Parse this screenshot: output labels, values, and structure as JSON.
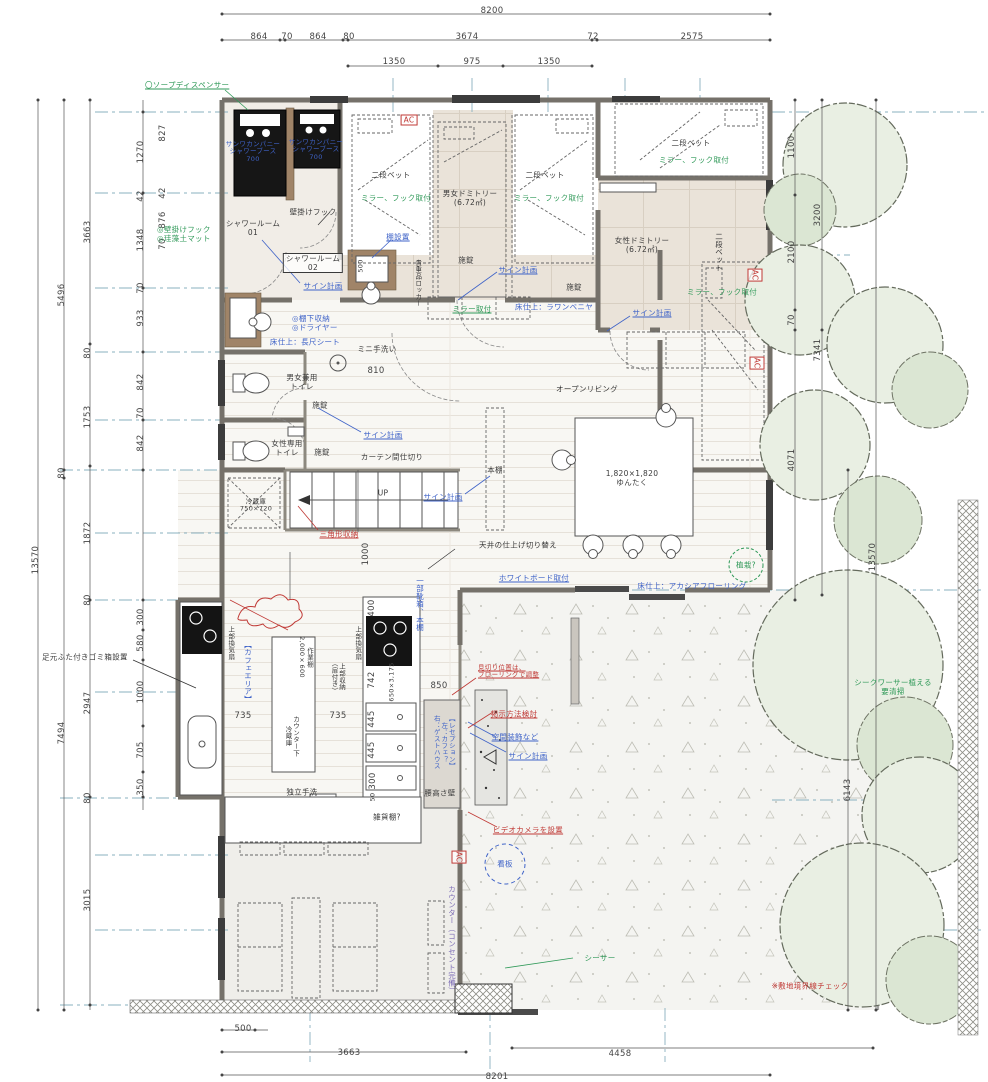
{
  "meta": {
    "drawing_type": "guesthouse-cafe floor plan",
    "unit": "mm"
  },
  "colors": {
    "annotation_green": "#2f9958",
    "annotation_blue": "#3f63c8",
    "annotation_red": "#c03a36",
    "wall": "#75716a",
    "floor_beige": "#eae3d9",
    "tree_green": "#e9efe3"
  },
  "labels": [
    {
      "t": "8200",
      "x": 492,
      "y": 11,
      "c": "dm",
      "n": "dim-top-total"
    },
    {
      "t": "864",
      "x": 259,
      "y": 37,
      "c": "dm"
    },
    {
      "t": "70",
      "x": 287,
      "y": 37,
      "c": "dm"
    },
    {
      "t": "864",
      "x": 318,
      "y": 37,
      "c": "dm"
    },
    {
      "t": "80",
      "x": 349,
      "y": 37,
      "c": "dm"
    },
    {
      "t": "3674",
      "x": 467,
      "y": 37,
      "c": "dm"
    },
    {
      "t": "72",
      "x": 593,
      "y": 37,
      "c": "dm"
    },
    {
      "t": "2575",
      "x": 692,
      "y": 37,
      "c": "dm"
    },
    {
      "t": "1350",
      "x": 394,
      "y": 62,
      "c": "dm"
    },
    {
      "t": "975",
      "x": 472,
      "y": 62,
      "c": "dm"
    },
    {
      "t": "1350",
      "x": 549,
      "y": 62,
      "c": "dm"
    },
    {
      "t": "13570",
      "x": 36,
      "y": 560,
      "c": "dm rv",
      "n": "dim-left-total"
    },
    {
      "t": "5496",
      "x": 62,
      "y": 295,
      "c": "dm rv"
    },
    {
      "t": "80",
      "x": 62,
      "y": 473,
      "c": "dm rv"
    },
    {
      "t": "7494",
      "x": 62,
      "y": 733,
      "c": "dm rv"
    },
    {
      "t": "3663",
      "x": 88,
      "y": 232,
      "c": "dm rv"
    },
    {
      "t": "80",
      "x": 88,
      "y": 353,
      "c": "dm rv"
    },
    {
      "t": "1753",
      "x": 88,
      "y": 417,
      "c": "dm rv"
    },
    {
      "t": "1872",
      "x": 88,
      "y": 533,
      "c": "dm rv"
    },
    {
      "t": "80",
      "x": 88,
      "y": 600,
      "c": "dm rv"
    },
    {
      "t": "2947",
      "x": 88,
      "y": 703,
      "c": "dm rv"
    },
    {
      "t": "80",
      "x": 88,
      "y": 798,
      "c": "dm rv"
    },
    {
      "t": "3015",
      "x": 88,
      "y": 900,
      "c": "dm rv"
    },
    {
      "t": "1270",
      "x": 141,
      "y": 152,
      "c": "dm rv"
    },
    {
      "t": "42",
      "x": 141,
      "y": 196,
      "c": "dm rv"
    },
    {
      "t": "1348",
      "x": 141,
      "y": 240,
      "c": "dm rv"
    },
    {
      "t": "70",
      "x": 141,
      "y": 288,
      "c": "dm rv"
    },
    {
      "t": "933",
      "x": 141,
      "y": 318,
      "c": "dm rv"
    },
    {
      "t": "842",
      "x": 141,
      "y": 382,
      "c": "dm rv"
    },
    {
      "t": "70",
      "x": 141,
      "y": 413,
      "c": "dm rv"
    },
    {
      "t": "842",
      "x": 141,
      "y": 443,
      "c": "dm rv"
    },
    {
      "t": "300",
      "x": 141,
      "y": 617,
      "c": "dm rv"
    },
    {
      "t": "580",
      "x": 141,
      "y": 643,
      "c": "dm rv"
    },
    {
      "t": "1000",
      "x": 141,
      "y": 692,
      "c": "dm rv"
    },
    {
      "t": "705",
      "x": 141,
      "y": 750,
      "c": "dm rv"
    },
    {
      "t": "350",
      "x": 141,
      "y": 787,
      "c": "dm rv"
    },
    {
      "t": "827",
      "x": 163,
      "y": 133,
      "c": "dm rv"
    },
    {
      "t": "42",
      "x": 163,
      "y": 193,
      "c": "dm rv"
    },
    {
      "t": "876",
      "x": 163,
      "y": 220,
      "c": "dm rv"
    },
    {
      "t": "70",
      "x": 163,
      "y": 244,
      "c": "dm rv"
    },
    {
      "t": "1100",
      "x": 792,
      "y": 147,
      "c": "dm rv"
    },
    {
      "t": "2100",
      "x": 792,
      "y": 252,
      "c": "dm rv"
    },
    {
      "t": "70",
      "x": 792,
      "y": 320,
      "c": "dm rv"
    },
    {
      "t": "4071",
      "x": 792,
      "y": 460,
      "c": "dm rv"
    },
    {
      "t": "3200",
      "x": 818,
      "y": 215,
      "c": "dm rv"
    },
    {
      "t": "7341",
      "x": 818,
      "y": 350,
      "c": "dm rv"
    },
    {
      "t": "13570",
      "x": 873,
      "y": 557,
      "c": "dm rv",
      "n": "dim-right-total"
    },
    {
      "t": "6143",
      "x": 848,
      "y": 790,
      "c": "dm rv"
    },
    {
      "t": "500",
      "x": 243,
      "y": 1029,
      "c": "dm"
    },
    {
      "t": "3663",
      "x": 349,
      "y": 1053,
      "c": "dm"
    },
    {
      "t": "4458",
      "x": 620,
      "y": 1054,
      "c": "dm"
    },
    {
      "t": "8201",
      "x": 497,
      "y": 1077,
      "c": "dm"
    },
    {
      "t": "735",
      "x": 243,
      "y": 716,
      "c": "dm"
    },
    {
      "t": "735",
      "x": 338,
      "y": 716,
      "c": "dm"
    },
    {
      "t": "850",
      "x": 439,
      "y": 686,
      "c": "dm"
    },
    {
      "t": "810",
      "x": 376,
      "y": 371,
      "c": "dm"
    },
    {
      "t": "400",
      "x": 372,
      "y": 608,
      "c": "dm rv"
    },
    {
      "t": "742",
      "x": 372,
      "y": 680,
      "c": "dm rv"
    },
    {
      "t": "445",
      "x": 372,
      "y": 719,
      "c": "dm rv"
    },
    {
      "t": "445",
      "x": 372,
      "y": 750,
      "c": "dm rv"
    },
    {
      "t": "300",
      "x": 373,
      "y": 781,
      "c": "dm rv"
    },
    {
      "t": "50",
      "x": 373,
      "y": 797,
      "c": "dm rv fs6"
    },
    {
      "t": "650×3,175",
      "x": 392,
      "y": 682,
      "c": "dm rv fs6"
    },
    {
      "t": "1000",
      "x": 366,
      "y": 554,
      "c": "dm rv"
    },
    {
      "t": "500",
      "x": 361,
      "y": 266,
      "c": "dm rv fs6"
    },
    {
      "t": "〇ソープディスペンサー",
      "x": 145,
      "y": 85,
      "c": "g u l fs7",
      "n": "note-soap-dispenser"
    },
    {
      "t": "◎壁掛けフック\n◎珪藻土マット",
      "x": 157,
      "y": 234,
      "c": "g l fs7",
      "n": "note-hook-mat"
    },
    {
      "t": "ミラー、フック取付",
      "x": 396,
      "y": 198,
      "c": "g fs7",
      "n": "note-mirror-hook"
    },
    {
      "t": "ミラー、フック取付",
      "x": 549,
      "y": 198,
      "c": "g fs7",
      "n": "note-mirror-hook"
    },
    {
      "t": "ミラー、フック取付",
      "x": 694,
      "y": 160,
      "c": "g fs7",
      "n": "note-mirror-hook"
    },
    {
      "t": "ミラー、フック取付",
      "x": 722,
      "y": 292,
      "c": "g fs7",
      "n": "note-mirror-hook"
    },
    {
      "t": "ミラー取付",
      "x": 472,
      "y": 309,
      "c": "g u fs7",
      "n": "note-mirror"
    },
    {
      "t": "シークワーサー植える\n要清掃",
      "x": 893,
      "y": 687,
      "c": "g fs7",
      "n": "note-shequasar-tree"
    },
    {
      "t": "シーサー",
      "x": 600,
      "y": 958,
      "c": "g fs7",
      "n": "note-shisa"
    },
    {
      "t": "植栽?",
      "x": 746,
      "y": 565,
      "c": "g fs7",
      "n": "note-planting"
    },
    {
      "t": "サンワカンパニー\nシャワーブース\n700",
      "x": 253,
      "y": 152,
      "c": "b fs6",
      "n": "note-shower-booth"
    },
    {
      "t": "サンワカンパニー\nシャワーブース\n700",
      "x": 316,
      "y": 150,
      "c": "b fs6",
      "n": "note-shower-booth"
    },
    {
      "t": "サイン計画",
      "x": 323,
      "y": 286,
      "c": "b u fs7",
      "n": "note-sign-plan"
    },
    {
      "t": "サイン計画",
      "x": 518,
      "y": 270,
      "c": "b u fs7",
      "n": "note-sign-plan"
    },
    {
      "t": "サイン計画",
      "x": 652,
      "y": 313,
      "c": "b u fs7",
      "n": "note-sign-plan"
    },
    {
      "t": "サイン計画",
      "x": 383,
      "y": 435,
      "c": "b u fs7",
      "n": "note-sign-plan"
    },
    {
      "t": "サイン計画",
      "x": 443,
      "y": 497,
      "c": "b u fs7",
      "n": "note-sign-plan"
    },
    {
      "t": "サイン計画",
      "x": 528,
      "y": 756,
      "c": "b u fs7",
      "n": "note-sign-plan"
    },
    {
      "t": "棚設置",
      "x": 398,
      "y": 237,
      "c": "b u fs7",
      "n": "note-shelf"
    },
    {
      "t": "◎棚下収納\n◎ドライヤー",
      "x": 292,
      "y": 323,
      "c": "b l fs7",
      "n": "note-under-shelf-dryer"
    },
    {
      "t": "床仕上：長尺シート",
      "x": 305,
      "y": 342,
      "c": "b fs7",
      "n": "note-floor-sheet"
    },
    {
      "t": "床仕上：ラワンベニヤ",
      "x": 554,
      "y": 307,
      "c": "b fs7",
      "n": "note-floor-lauan"
    },
    {
      "t": "床仕上：アカシアフローリング",
      "x": 692,
      "y": 586,
      "c": "b fs7",
      "n": "note-floor-acacia"
    },
    {
      "t": "ホワイトボード取付",
      "x": 534,
      "y": 578,
      "c": "b u fs7",
      "n": "note-whiteboard"
    },
    {
      "t": "一部靴箱、本棚",
      "x": 420,
      "y": 604,
      "c": "b v fs7",
      "n": "note-shoebox-bookshelf"
    },
    {
      "t": "看板",
      "x": 505,
      "y": 864,
      "c": "b fs7",
      "n": "note-signboard"
    },
    {
      "t": "空間装飾など",
      "x": 515,
      "y": 737,
      "c": "b u fs7",
      "n": "note-decoration"
    },
    {
      "t": "カウンター（コンセント完備）",
      "x": 452,
      "y": 940,
      "c": "p v fs7",
      "n": "note-counter-outlets"
    },
    {
      "t": "【カフェエリア】",
      "x": 248,
      "y": 672,
      "c": "b v fs7",
      "n": "room-cafe-area"
    },
    {
      "t": "【レセプション】\n左：カフェ？\n右：ゲストハウス",
      "x": 443,
      "y": 742,
      "c": "b v fs6",
      "n": "room-reception"
    },
    {
      "t": "カーテン間仕切り",
      "x": 392,
      "y": 457,
      "c": "fs7",
      "n": "note-curtain-partition"
    },
    {
      "t": "UP",
      "x": 383,
      "y": 493,
      "c": "fs7",
      "n": "stair-up"
    },
    {
      "t": "壁掛けフック",
      "x": 313,
      "y": 212,
      "c": "fs7",
      "n": "note-wall-hook"
    },
    {
      "t": "シャワールーム\n01",
      "x": 253,
      "y": 228,
      "c": "fs7",
      "n": "room-shower-01"
    },
    {
      "t": "シャワールーム\n02",
      "x": 313,
      "y": 263,
      "c": "fs7 box",
      "n": "room-shower-02"
    },
    {
      "t": "二段ベット",
      "x": 391,
      "y": 175,
      "c": "fs7",
      "n": "furniture-bunk-bed"
    },
    {
      "t": "二段ベット",
      "x": 545,
      "y": 175,
      "c": "fs7",
      "n": "furniture-bunk-bed"
    },
    {
      "t": "二段ベット",
      "x": 691,
      "y": 143,
      "c": "fs7",
      "n": "furniture-bunk-bed"
    },
    {
      "t": "二段ベット",
      "x": 719,
      "y": 252,
      "c": "fs7 v",
      "n": "furniture-bunk-bed"
    },
    {
      "t": "男女ドミトリー\n(6.72㎡)",
      "x": 470,
      "y": 198,
      "c": "fs7",
      "n": "room-mixed-dormitory"
    },
    {
      "t": "女性ドミトリー\n(6.72㎡)",
      "x": 642,
      "y": 245,
      "c": "fs7",
      "n": "room-womens-dormitory"
    },
    {
      "t": "貴重品ロッカー",
      "x": 417,
      "y": 283,
      "c": "fs6 v",
      "n": "furniture-valuables-locker"
    },
    {
      "t": "施錠",
      "x": 466,
      "y": 260,
      "c": "fs7",
      "n": "note-lock"
    },
    {
      "t": "施錠",
      "x": 574,
      "y": 287,
      "c": "fs7",
      "n": "note-lock"
    },
    {
      "t": "施錠",
      "x": 320,
      "y": 405,
      "c": "fs7",
      "n": "note-lock"
    },
    {
      "t": "施錠",
      "x": 322,
      "y": 452,
      "c": "fs7",
      "n": "note-lock"
    },
    {
      "t": "ミニ手洗い",
      "x": 377,
      "y": 349,
      "c": "fs7",
      "n": "note-mini-sink"
    },
    {
      "t": "男女兼用\nトイレ",
      "x": 302,
      "y": 382,
      "c": "fs7",
      "n": "room-unisex-toilet"
    },
    {
      "t": "女性専用\nトイレ",
      "x": 287,
      "y": 448,
      "c": "fs7",
      "n": "room-womens-toilet"
    },
    {
      "t": "冷蔵庫\n750×720",
      "x": 256,
      "y": 506,
      "c": "fs6",
      "n": "furniture-fridge"
    },
    {
      "t": "オープンリビング",
      "x": 587,
      "y": 389,
      "c": "fs7",
      "n": "room-open-living"
    },
    {
      "t": "本棚",
      "x": 495,
      "y": 470,
      "c": "fs7",
      "n": "furniture-bookshelf"
    },
    {
      "t": "1,820×1,820\nゆんたく",
      "x": 632,
      "y": 478,
      "c": "fs7",
      "n": "furniture-yuntaku-table"
    },
    {
      "t": "天井の仕上げ切り替え",
      "x": 518,
      "y": 545,
      "c": "fs7",
      "n": "note-ceiling-finish"
    },
    {
      "t": "作業棚\n2,000×600",
      "x": 305,
      "y": 657,
      "c": "fs6 v",
      "n": "furniture-work-shelf"
    },
    {
      "t": "カウンター下\n冷蔵庫",
      "x": 291,
      "y": 736,
      "c": "fs6 v",
      "n": "furniture-undercounter-fridge"
    },
    {
      "t": "上部収納\n（扉付き）",
      "x": 337,
      "y": 677,
      "c": "fs6 v",
      "n": "note-upper-storage"
    },
    {
      "t": "上部換気扇",
      "x": 230,
      "y": 643,
      "c": "fs6 v",
      "n": "note-vent-fan"
    },
    {
      "t": "上部換気扇",
      "x": 357,
      "y": 643,
      "c": "fs6 v",
      "n": "note-vent-fan"
    },
    {
      "t": "独立手洗",
      "x": 302,
      "y": 792,
      "c": "fs7",
      "n": "note-standalone-sink"
    },
    {
      "t": "雑貨棚?",
      "x": 387,
      "y": 817,
      "c": "fs7",
      "n": "furniture-goods-shelf"
    },
    {
      "t": "腰高さ壁",
      "x": 440,
      "y": 793,
      "c": "fs7",
      "n": "note-waist-wall"
    },
    {
      "t": "足元ふた付きゴミ箱設置",
      "x": 42,
      "y": 657,
      "c": "l fs7",
      "n": "note-trash-bin"
    },
    {
      "t": "AC",
      "x": 409,
      "y": 120,
      "c": "r box fs7",
      "n": "ac-unit"
    },
    {
      "t": "AC",
      "x": 755,
      "y": 275,
      "c": "r box v fs7",
      "n": "ac-unit"
    },
    {
      "t": "AC",
      "x": 757,
      "y": 363,
      "c": "r box v fs7",
      "n": "ac-unit"
    },
    {
      "t": "AC",
      "x": 459,
      "y": 857,
      "c": "r box v fs7",
      "n": "ac-unit"
    },
    {
      "t": "三角形収納",
      "x": 339,
      "y": 534,
      "c": "r u fs7",
      "n": "note-triangle-storage"
    },
    {
      "t": "見切り位置は、\nフローリングで調整",
      "x": 478,
      "y": 672,
      "c": "r l u fs6",
      "n": "note-flooring-joint"
    },
    {
      "t": "掲示方法検討",
      "x": 514,
      "y": 714,
      "c": "r u fs7",
      "n": "note-display-method"
    },
    {
      "t": "ビデオカメラを設置",
      "x": 528,
      "y": 830,
      "c": "r u fs7",
      "n": "note-video-camera"
    },
    {
      "t": "※敷地境界線チェック",
      "x": 810,
      "y": 986,
      "c": "r fs7",
      "n": "note-boundary-check"
    }
  ]
}
